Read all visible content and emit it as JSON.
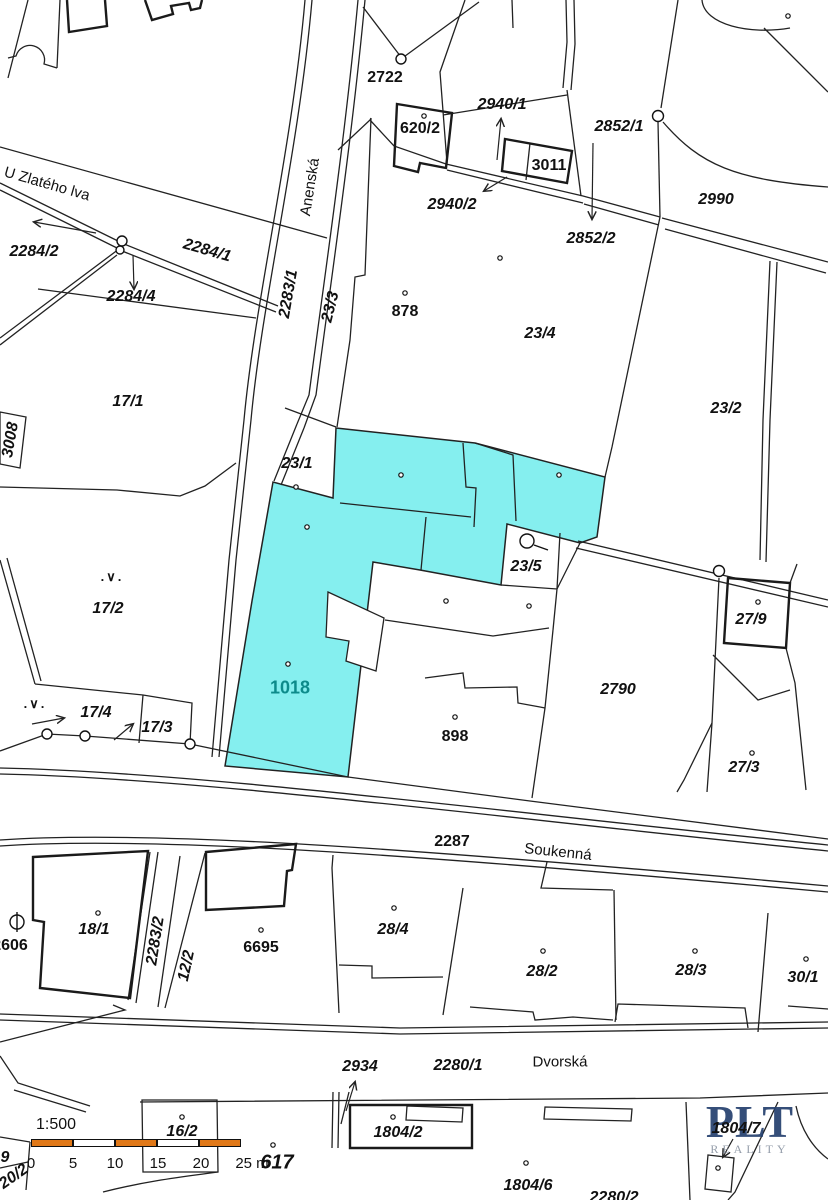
{
  "map": {
    "highlight_color": "#85EFEF",
    "line_color": "#222222",
    "labels": [
      {
        "id": "street-u-zlateho-lva",
        "text": "U Zlatého lva",
        "x": 47,
        "y": 184,
        "rot": 16,
        "cls": "street"
      },
      {
        "id": "street-anenska",
        "text": "Anenská",
        "x": 310,
        "y": 187,
        "rot": -81,
        "cls": "street"
      },
      {
        "id": "street-soukenna",
        "text": "Soukenná",
        "x": 558,
        "y": 852,
        "rot": 6,
        "cls": "street"
      },
      {
        "id": "street-dvorska",
        "text": "Dvorská",
        "x": 560,
        "y": 1062,
        "rot": 0,
        "cls": "street"
      },
      {
        "id": "parcel-2284-2",
        "text": "2284/2",
        "x": 34,
        "y": 252,
        "rot": 0,
        "cls": "pi"
      },
      {
        "id": "parcel-2284-1",
        "text": "2284/1",
        "x": 207,
        "y": 251,
        "rot": 16,
        "cls": "pi"
      },
      {
        "id": "parcel-2284-4",
        "text": "2284/4",
        "x": 131,
        "y": 297,
        "rot": 0,
        "cls": "pi"
      },
      {
        "id": "parcel-2722",
        "text": "2722",
        "x": 385,
        "y": 78,
        "rot": 0,
        "cls": "pu"
      },
      {
        "id": "parcel-620-2",
        "text": "620/2",
        "x": 420,
        "y": 129,
        "rot": 0,
        "cls": "pu"
      },
      {
        "id": "parcel-2940-1",
        "text": "2940/1",
        "x": 502,
        "y": 105,
        "rot": 0,
        "cls": "pi"
      },
      {
        "id": "parcel-3011",
        "text": "3011",
        "x": 549,
        "y": 166,
        "rot": 0,
        "cls": "pu"
      },
      {
        "id": "parcel-2852-1",
        "text": "2852/1",
        "x": 619,
        "y": 127,
        "rot": 0,
        "cls": "pi"
      },
      {
        "id": "parcel-2940-2",
        "text": "2940/2",
        "x": 452,
        "y": 205,
        "rot": 0,
        "cls": "pi"
      },
      {
        "id": "parcel-2852-2",
        "text": "2852/2",
        "x": 591,
        "y": 239,
        "rot": 0,
        "cls": "pi"
      },
      {
        "id": "parcel-2990",
        "text": "2990",
        "x": 716,
        "y": 200,
        "rot": 0,
        "cls": "pi"
      },
      {
        "id": "parcel-17-1",
        "text": "17/1",
        "x": 128,
        "y": 402,
        "rot": 0,
        "cls": "pi"
      },
      {
        "id": "parcel-3008",
        "text": "3008",
        "x": 11,
        "y": 440,
        "rot": -80,
        "cls": "pi"
      },
      {
        "id": "parcel-2283-1",
        "text": "2283/1",
        "x": 289,
        "y": 294,
        "rot": -80,
        "cls": "pi"
      },
      {
        "id": "parcel-23-3",
        "text": "23/3",
        "x": 331,
        "y": 307,
        "rot": -76,
        "cls": "pi"
      },
      {
        "id": "parcel-878",
        "text": "878",
        "x": 405,
        "y": 312,
        "rot": 0,
        "cls": "pu"
      },
      {
        "id": "parcel-23-4",
        "text": "23/4",
        "x": 540,
        "y": 334,
        "rot": 0,
        "cls": "pi"
      },
      {
        "id": "parcel-23-2",
        "text": "23/2",
        "x": 726,
        "y": 409,
        "rot": 0,
        "cls": "pi"
      },
      {
        "id": "parcel-23-1",
        "text": "23/1",
        "x": 297,
        "y": 464,
        "rot": 0,
        "cls": "pi"
      },
      {
        "id": "parcel-17-2",
        "text": "17/2",
        "x": 108,
        "y": 609,
        "rot": 0,
        "cls": "pi"
      },
      {
        "id": "parcel-23-5",
        "text": "23/5",
        "x": 526,
        "y": 567,
        "rot": 0,
        "cls": "pi"
      },
      {
        "id": "parcel-27-9",
        "text": "27/9",
        "x": 751,
        "y": 620,
        "rot": 0,
        "cls": "pi"
      },
      {
        "id": "parcel-2790",
        "text": "2790",
        "x": 618,
        "y": 690,
        "rot": 0,
        "cls": "pi"
      },
      {
        "id": "parcel-1018",
        "text": "1018",
        "x": 290,
        "y": 688,
        "rot": 0,
        "cls": "teal"
      },
      {
        "id": "parcel-898",
        "text": "898",
        "x": 455,
        "y": 737,
        "rot": 0,
        "cls": "pu"
      },
      {
        "id": "parcel-27-3",
        "text": "27/3",
        "x": 744,
        "y": 768,
        "rot": 0,
        "cls": "pi"
      },
      {
        "id": "parcel-17-4",
        "text": "17/4",
        "x": 96,
        "y": 713,
        "rot": 0,
        "cls": "pi"
      },
      {
        "id": "parcel-17-3",
        "text": "17/3",
        "x": 157,
        "y": 728,
        "rot": 0,
        "cls": "pi"
      },
      {
        "id": "parcel-2287",
        "text": "2287",
        "x": 452,
        "y": 842,
        "rot": 0,
        "cls": "pu"
      },
      {
        "id": "parcel-2606",
        "text": "2606",
        "x": 10,
        "y": 946,
        "rot": 0,
        "cls": "pu"
      },
      {
        "id": "parcel-18-1",
        "text": "18/1",
        "x": 94,
        "y": 930,
        "rot": 0,
        "cls": "pi"
      },
      {
        "id": "parcel-2283-2",
        "text": "2283/2",
        "x": 156,
        "y": 941,
        "rot": -81,
        "cls": "pi"
      },
      {
        "id": "parcel-12-2",
        "text": "12/2",
        "x": 187,
        "y": 966,
        "rot": -78,
        "cls": "pi"
      },
      {
        "id": "parcel-6695",
        "text": "6695",
        "x": 261,
        "y": 948,
        "rot": 0,
        "cls": "pu"
      },
      {
        "id": "parcel-28-4",
        "text": "28/4",
        "x": 393,
        "y": 930,
        "rot": 0,
        "cls": "pi"
      },
      {
        "id": "parcel-28-2",
        "text": "28/2",
        "x": 542,
        "y": 972,
        "rot": 0,
        "cls": "pi"
      },
      {
        "id": "parcel-28-3",
        "text": "28/3",
        "x": 691,
        "y": 971,
        "rot": 0,
        "cls": "pi"
      },
      {
        "id": "parcel-30-1",
        "text": "30/1",
        "x": 803,
        "y": 978,
        "rot": 0,
        "cls": "pi"
      },
      {
        "id": "parcel-2934",
        "text": "2934",
        "x": 360,
        "y": 1067,
        "rot": 0,
        "cls": "pi"
      },
      {
        "id": "parcel-2280-1",
        "text": "2280/1",
        "x": 458,
        "y": 1066,
        "rot": 0,
        "cls": "pi"
      },
      {
        "id": "parcel-16-2",
        "text": "16/2",
        "x": 182,
        "y": 1132,
        "rot": 0,
        "cls": "pi"
      },
      {
        "id": "parcel-617",
        "text": "617",
        "x": 277,
        "y": 1163,
        "rot": 0,
        "cls": "big"
      },
      {
        "id": "parcel-1804-2",
        "text": "1804/2",
        "x": 398,
        "y": 1133,
        "rot": 0,
        "cls": "pi"
      },
      {
        "id": "parcel-1804-6",
        "text": "1804/6",
        "x": 528,
        "y": 1186,
        "rot": 0,
        "cls": "pi"
      },
      {
        "id": "parcel-1804-7",
        "text": "1804/7",
        "x": 736,
        "y": 1129,
        "rot": 0,
        "cls": "pi"
      },
      {
        "id": "parcel-2280-2",
        "text": "2280/2",
        "x": 614,
        "y": 1198,
        "rot": 0,
        "cls": "pi"
      },
      {
        "id": "parcel-9",
        "text": "9",
        "x": 5,
        "y": 1158,
        "rot": 0,
        "cls": "pi"
      },
      {
        "id": "parcel-20-2",
        "text": "20/2",
        "x": 14,
        "y": 1177,
        "rot": -35,
        "cls": "pi"
      },
      {
        "id": "landuse-symbol-1",
        "text": ".∨.",
        "x": 112,
        "y": 577,
        "rot": 0,
        "cls": "sym"
      },
      {
        "id": "landuse-symbol-2",
        "text": ".∨.",
        "x": 35,
        "y": 704,
        "rot": 0,
        "cls": "sym"
      }
    ],
    "teal_label_color": "#0D8B8B",
    "scalebar": {
      "ratio": "1:500",
      "orange": "#E07818",
      "bar": {
        "x": 31,
        "y": 1139,
        "h": 8,
        "seg_w": 42
      },
      "segments": [
        "orange",
        "white",
        "orange",
        "white",
        "orange"
      ],
      "ticks": [
        {
          "t": "0",
          "x": 31
        },
        {
          "t": "5",
          "x": 73
        },
        {
          "t": "10",
          "x": 115
        },
        {
          "t": "15",
          "x": 158
        },
        {
          "t": "20",
          "x": 201
        },
        {
          "t": "25 m",
          "x": 252
        }
      ],
      "tick_y": 1155
    },
    "logo": {
      "line1": "PLT",
      "line2": "REALITY",
      "color1": "#24406E",
      "color2": "#8C95A3"
    }
  }
}
